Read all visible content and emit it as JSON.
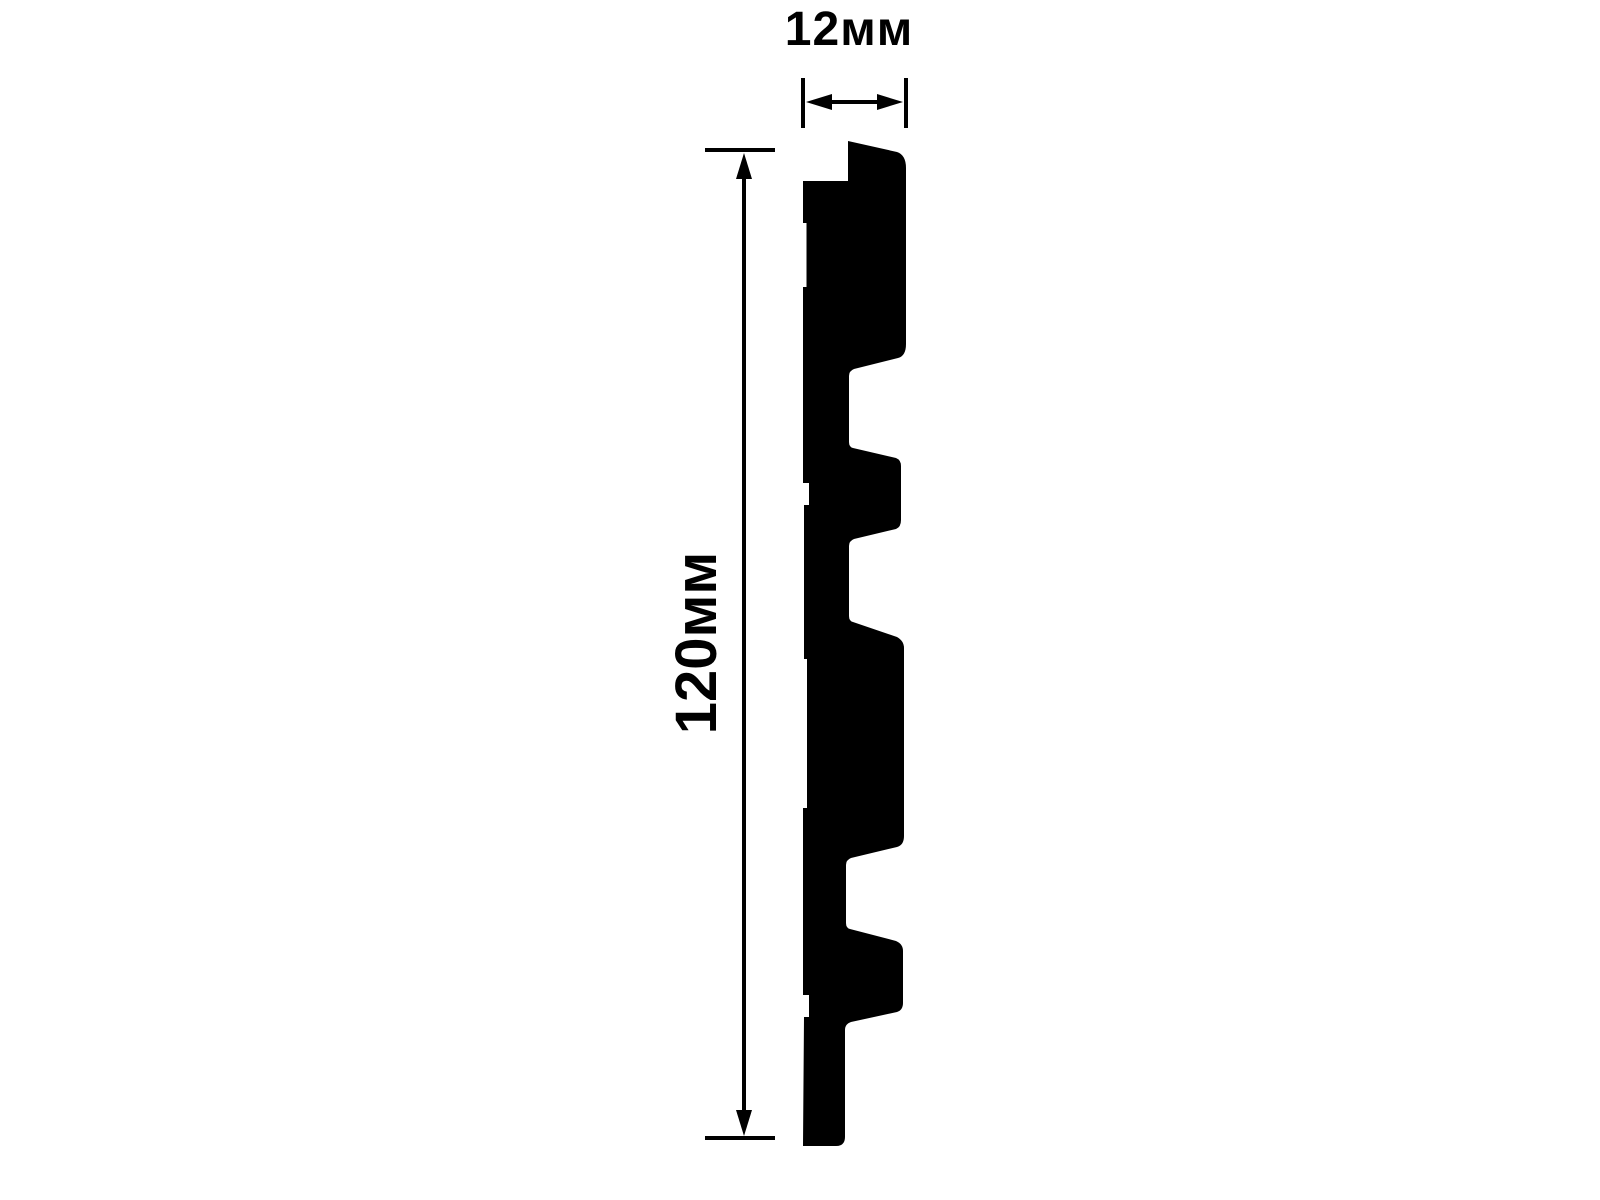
{
  "colors": {
    "ink": "#000000",
    "background": "#ffffff"
  },
  "profile": {
    "path": "M848,141 L897,152 Q906,155 906,168 L906,344 Q906,356 898,358 L854,369 Q849,371 849,376 L849,442 Q849,447 853,448 L896,458 Q901,460 901,466 L901,520 Q901,527 896,529 L854,539 Q849,541 849,546 L849,616 Q849,621 853,622 L897,637 Q904,641 904,648 L904,836 Q904,845 897,847 L851,858 Q846,860 846,865 L846,923 Q846,928 850,929 L896,941 Q903,944 903,951 L903,1003 Q903,1010 897,1012 L851,1022 Q845,1024 845,1030 L845,1137 Q845,1146 836,1146 L803,1146 L804,1017 L809,1017 L809,995 L803,995 L803,808 L807,808 L807,659 L804,659 L804,505 L809,505 L809,483 L803,483 L803,287 L806.5,287 L806.5,223 L803,223 L803,181 L848,181 Z"
  },
  "dims": {
    "width": {
      "label": "12мм",
      "tick_left": {
        "x1": 803,
        "y1": 78,
        "x2": 803,
        "y2": 128
      },
      "tick_right": {
        "x1": 906,
        "y1": 78,
        "x2": 906,
        "y2": 128
      },
      "shaft": {
        "x1": 828,
        "y1": 102,
        "x2": 881,
        "y2": 102
      },
      "head_left": "806,102 832,94 832,110",
      "head_right": "903,102 877,94 877,110"
    },
    "height": {
      "label": "120мм",
      "tick_top": {
        "x1": 705,
        "y1": 150,
        "x2": 775,
        "y2": 150
      },
      "tick_bottom": {
        "x1": 705,
        "y1": 1138,
        "x2": 775,
        "y2": 1138
      },
      "shaft": {
        "x1": 744,
        "y1": 176,
        "x2": 744,
        "y2": 1112
      },
      "head_top": "744,153 736,179 752,179",
      "head_bottom": "744,1136 736,1110 752,1110"
    }
  }
}
